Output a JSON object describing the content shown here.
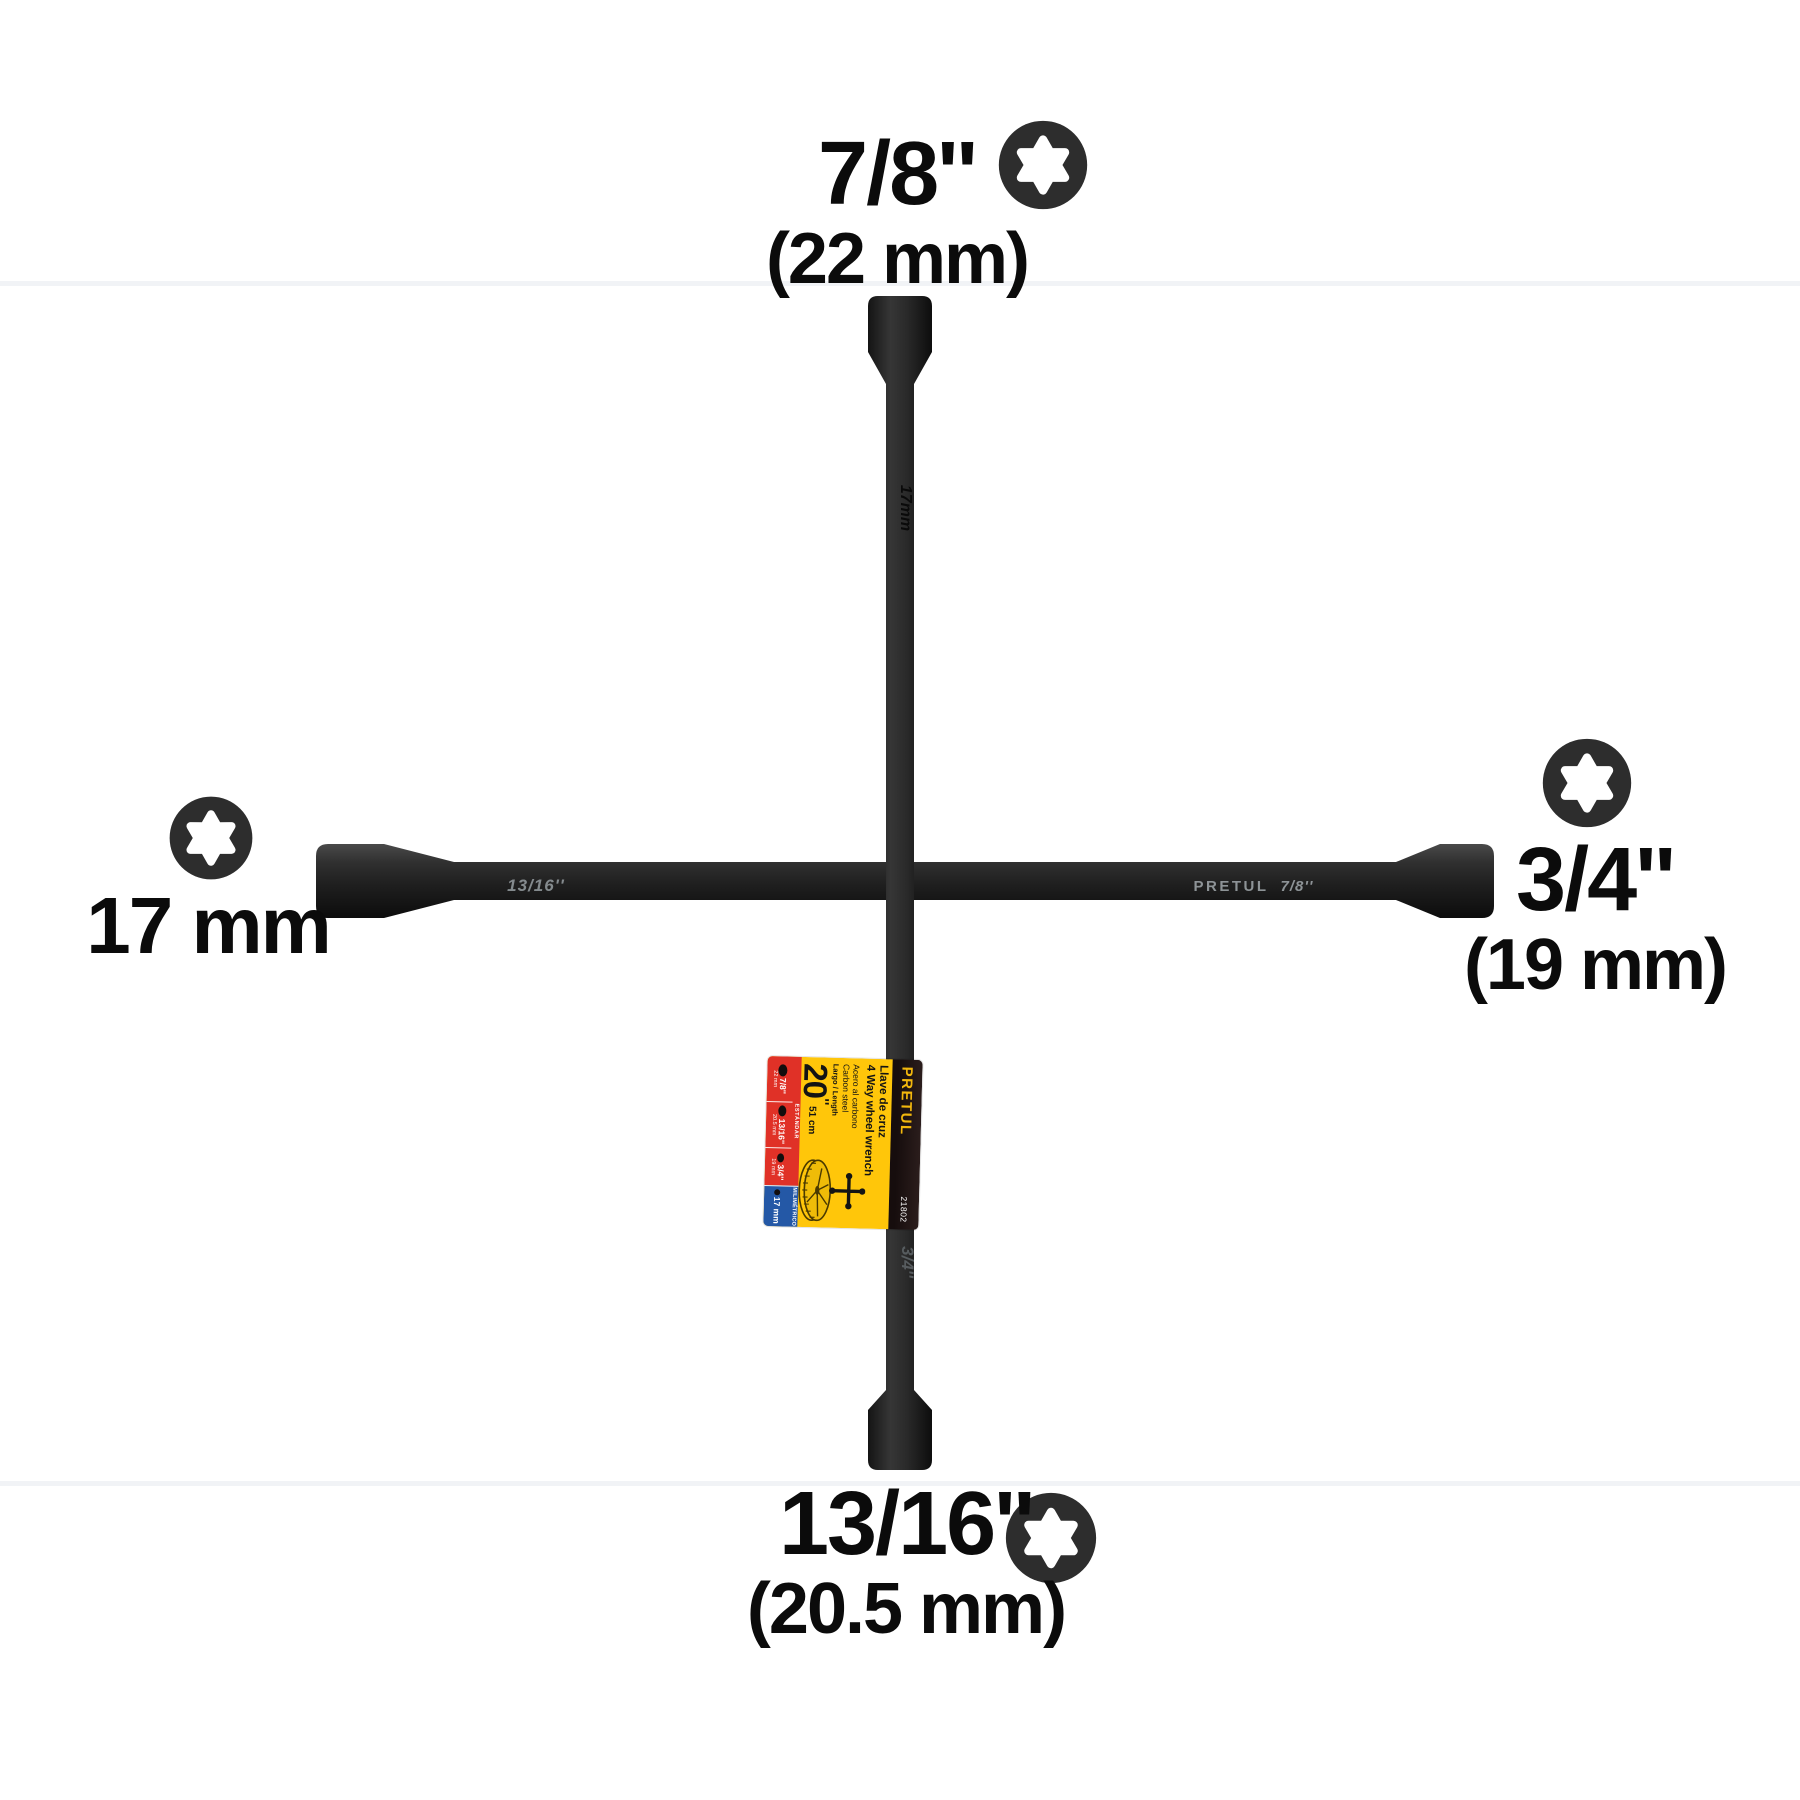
{
  "annotations": {
    "top": {
      "size": "7/8''",
      "metric": "(22 mm)"
    },
    "right": {
      "size": "3/4''",
      "metric": "(19 mm)"
    },
    "bottom": {
      "size": "13/16''",
      "metric": "(20.5 mm)"
    },
    "left": {
      "size": "17 mm"
    }
  },
  "engravings": {
    "left_arm": "13/16''",
    "right_brand": "PRETUL",
    "right_size": "7/8''",
    "top_arm": "17mm",
    "bottom_arm": "3/4''"
  },
  "tag": {
    "brand": "PRETUL",
    "sku": "21802",
    "title_es": "Llave de cruz",
    "title_en": "4 Way wheel wrench",
    "material_es": "Acero al carbono",
    "material_en": "Carbon steel",
    "length_label": "Largo / Length",
    "length_in": "20",
    "length_quote": "''",
    "length_cm": "51 cm",
    "standard_label": "ESTÁNDAR",
    "metric_label": "MILIMÉTRICO",
    "sizes": [
      {
        "size": "7/8''",
        "mm": "22 mm"
      },
      {
        "size": "13/16''",
        "mm": "20.5 mm"
      },
      {
        "size": "3/4''",
        "mm": "19 mm"
      },
      {
        "size": "17 mm",
        "mm": ""
      }
    ],
    "colors": {
      "yellow": "#ffc60a",
      "red": "#e03127",
      "blue": "#2458a6",
      "black_band": "#1c1212"
    }
  }
}
